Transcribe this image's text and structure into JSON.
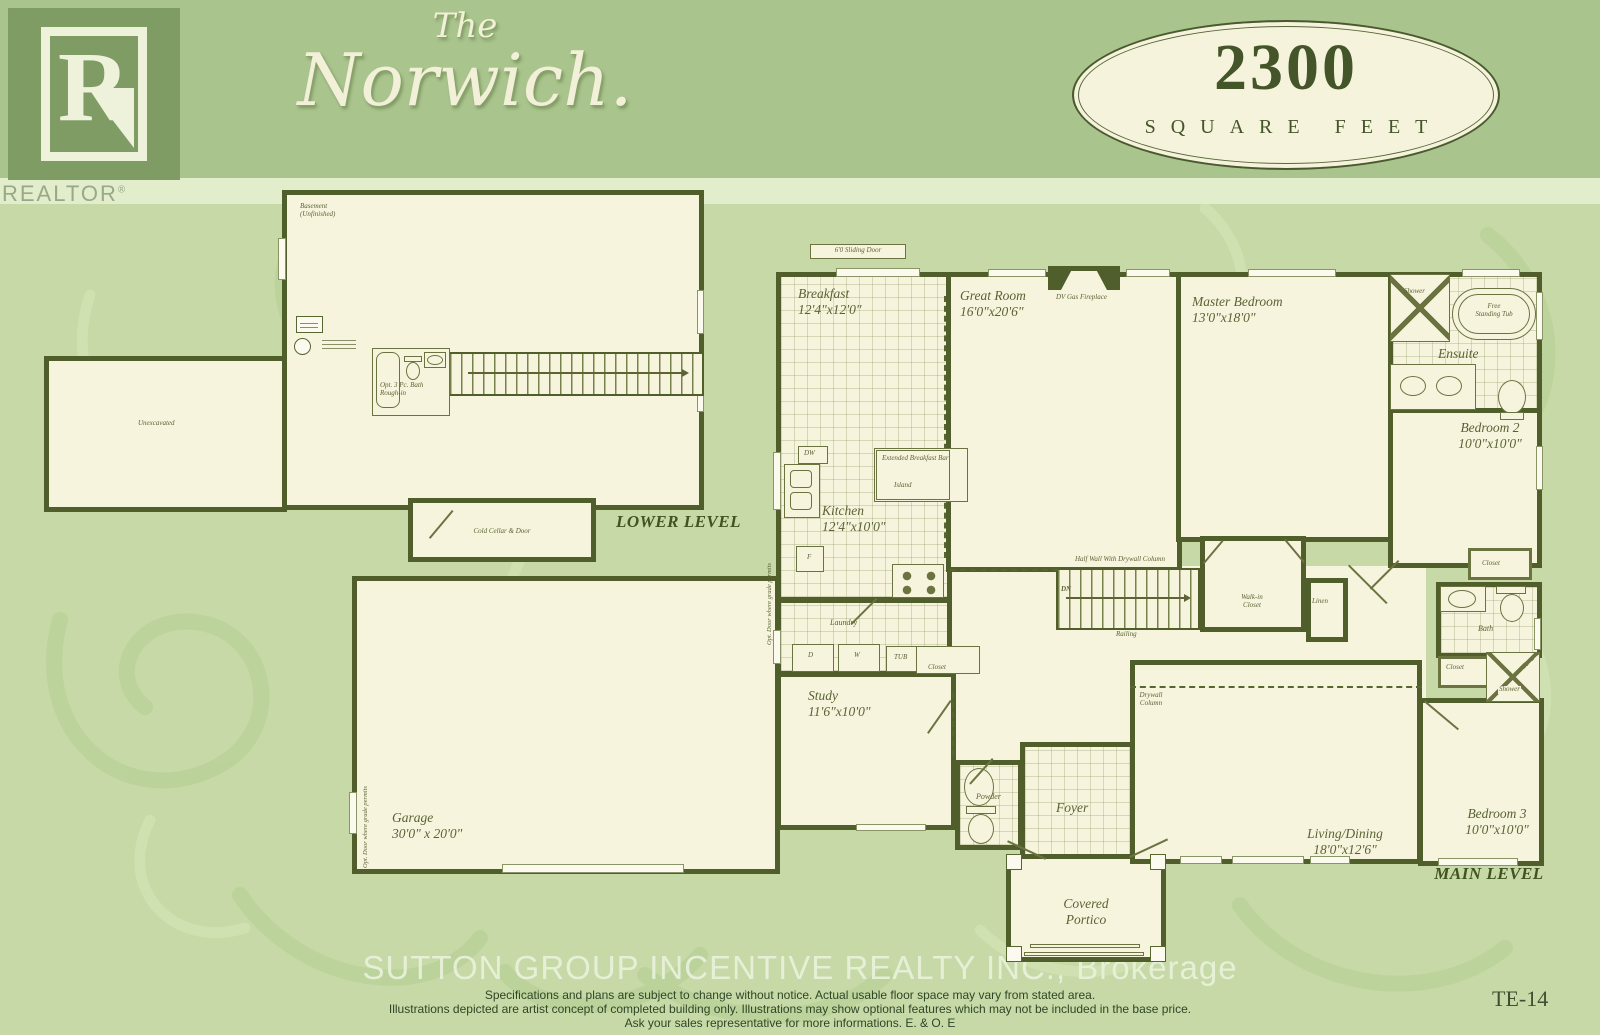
{
  "header": {
    "logo_letter": "R",
    "logo_caption": "REALTOR",
    "logo_reg": "®",
    "title_prefix": "The",
    "title_name": "Norwich.",
    "badge_number": "2300",
    "badge_caption": "SQUARE FEET"
  },
  "colors": {
    "header_band_green": "#a9c48d",
    "body_green": "#c6d9a6",
    "wall_olive": "#4f5e2b",
    "floor_cream": "#f7f4de",
    "label_olive": "#5a6234",
    "badge_cream": "#f6f3dc"
  },
  "lower_level": {
    "section_label": "LOWER LEVEL",
    "basement_note": "Basement (Unfinished)",
    "unexcavated": "Unexcavated",
    "cold_cellar": "Cold Cellar & Door",
    "bath_roughin": "Opt. 3 Pc. Bath Rough-in"
  },
  "main_level": {
    "section_label": "MAIN LEVEL",
    "breakfast_name": "Breakfast",
    "breakfast_dims": "12'4\"x12'0\"",
    "great_room_name": "Great Room",
    "great_room_dims": "16'0\"x20'6\"",
    "master_name": "Master Bedroom",
    "master_dims": "13'0\"x18'0\"",
    "kitchen_name": "Kitchen",
    "kitchen_dims": "12'4\"x10'0\"",
    "study_name": "Study",
    "study_dims": "11'6\"x10'0\"",
    "garage_name": "Garage",
    "garage_dims": "30'0\" x 20'0\"",
    "living_name": "Living/Dining",
    "living_dims": "18'0\"x12'6\"",
    "bedroom2_name": "Bedroom 2",
    "bedroom2_dims": "10'0\"x10'0\"",
    "bedroom3_name": "Bedroom 3",
    "bedroom3_dims": "10'0\"x10'0\"",
    "ensuite": "Ensuite",
    "bath": "Bath",
    "powder": "Powder",
    "foyer": "Foyer",
    "laundry": "Laundry",
    "portico_line1": "Covered",
    "portico_line2": "Portico",
    "sliding_door": "6'0 Sliding Door",
    "fireplace": "DV Gas Fireplace",
    "ext_breakfast_bar": "Extended Breakfast Bar",
    "island": "Island",
    "dw": "DW",
    "fridge": "F",
    "dryer": "D",
    "washer": "W",
    "tub": "TUB",
    "half_wall": "Half Wall With Drywall Column",
    "dn": "DN",
    "railing": "Railing",
    "walk_in_line1": "Walk-in",
    "walk_in_line2": "Closet",
    "linen": "Linen",
    "drywall_line1": "Drywall",
    "drywall_line2": "Column",
    "closet": "Closet",
    "shower": "Shower",
    "free_tub_line1": "Free",
    "free_tub_line2": "Standing Tub",
    "opt_door": "Opt. Door where grade permits"
  },
  "footer": {
    "brokerage": "SUTTON GROUP INCENTIVE REALTY INC., Brokerage",
    "line1": "Specifications and plans are subject to change without notice. Actual usable floor space may vary from stated area.",
    "line2": "Illustrations depicted are artist concept of completed building only. Illustrations may show optional features which may not be included in the base price.",
    "line3": "Ask your sales representative for more informations. E. & O. E",
    "sheet_code": "TE-14"
  }
}
